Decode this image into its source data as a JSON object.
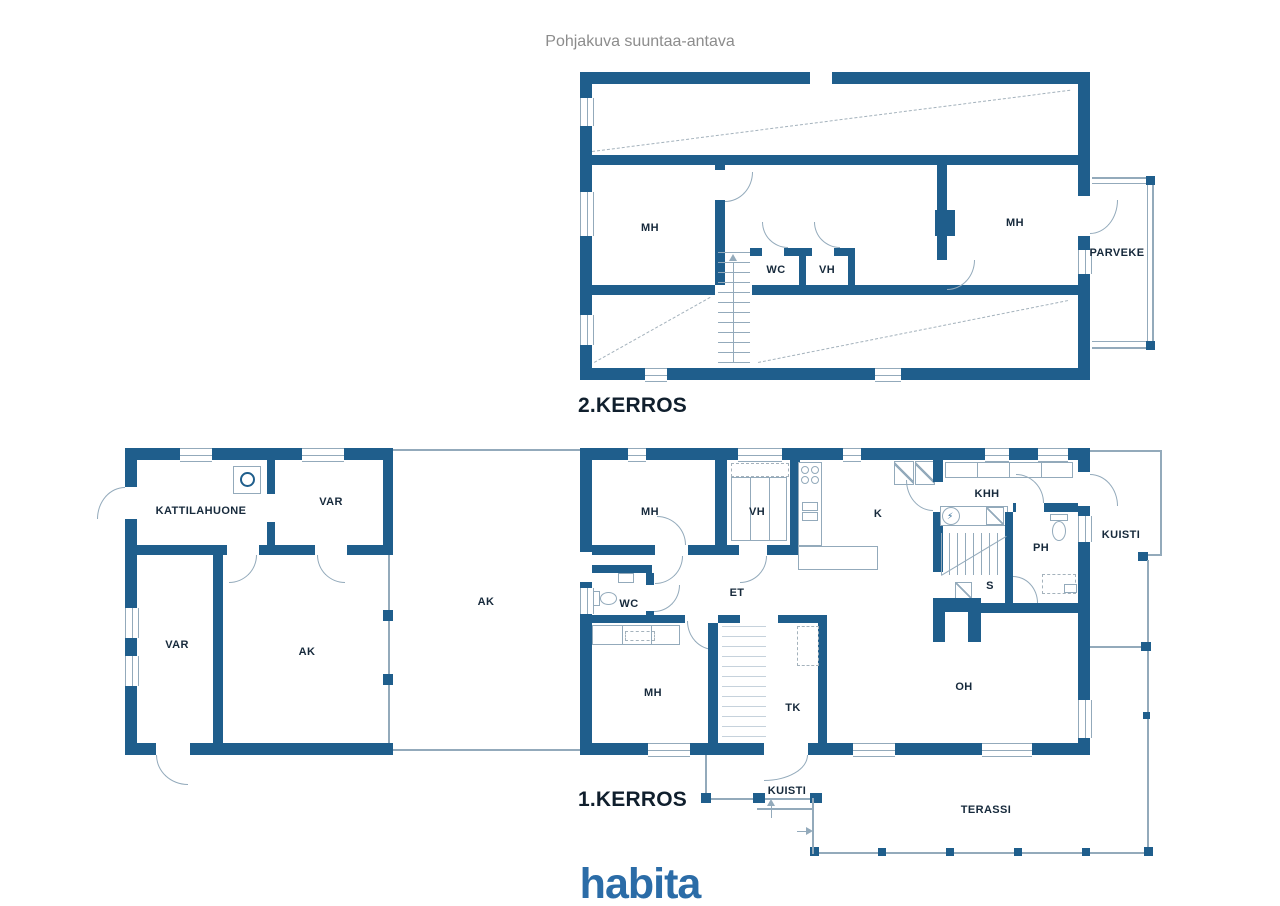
{
  "title": "Pohjakuva suuntaa-antava",
  "brand": {
    "logo_text": "habita",
    "logo_color": "#2b6ca7"
  },
  "colors": {
    "wall": "#1f5e8c",
    "thin_line": "#93aabb",
    "dashed_line": "#a4b2bc",
    "label_ink": "#16293b",
    "title_gray": "#8c8c8c"
  },
  "floor2": {
    "name": "2.KERROS",
    "rooms": {
      "mh_left": "MH",
      "wc": "WC",
      "vh": "VH",
      "mh_right": "MH",
      "parveke": "PARVEKE"
    }
  },
  "floor1": {
    "name": "1.KERROS",
    "rooms": {
      "kattilahuone": "KATTILAHUONE",
      "var_top": "VAR",
      "var_left": "VAR",
      "ak_garage": "AK",
      "ak_carport": "AK",
      "mh_top": "MH",
      "vh": "VH",
      "k": "K",
      "khh": "KHH",
      "wc": "WC",
      "et": "ET",
      "ph": "PH",
      "s": "S",
      "mh_bottom": "MH",
      "tk": "TK",
      "oh": "OH",
      "kuisti_right": "KUISTI",
      "kuisti_bottom": "KUISTI",
      "terassi": "TERASSI"
    }
  }
}
